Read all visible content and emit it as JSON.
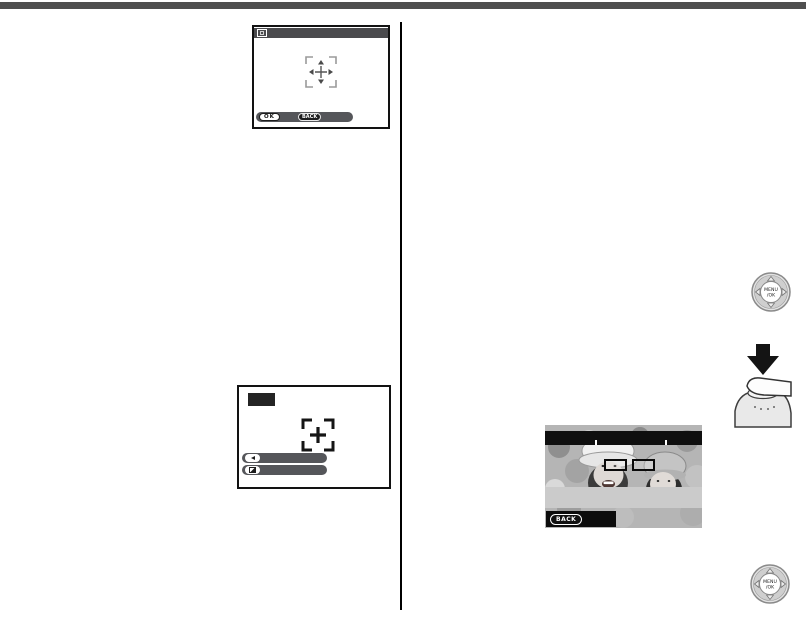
{
  "page": {
    "bg_color": "#ffffff",
    "top_rule_color": "#4f4f4f",
    "divider_color": "#000000"
  },
  "lcd_focus_select": {
    "titlebar_color": "#4a4a4d",
    "title_icon": "af-area-select-icon",
    "ok_label": "OK",
    "back_label": "BACK",
    "bottom_bar_color": "#55565a",
    "center_icon": "focus-frame-crosshair"
  },
  "lcd_af_confirm": {
    "mode_icon": "mode-tile-icon",
    "center_icon": "af-target-brackets",
    "row1_icon": "left-arrow-icon",
    "row2_icon": "exposure-compensation-icon",
    "bar_color": "#55565a"
  },
  "photo_screen": {
    "back_label": "BACK",
    "overlay_bar_color": "#0f0f0f",
    "menu_band_color": "#cbcbcb",
    "eye_frame_count": 2
  },
  "menu_ok_button": {
    "line1": "MENU",
    "line2": "/OK"
  }
}
